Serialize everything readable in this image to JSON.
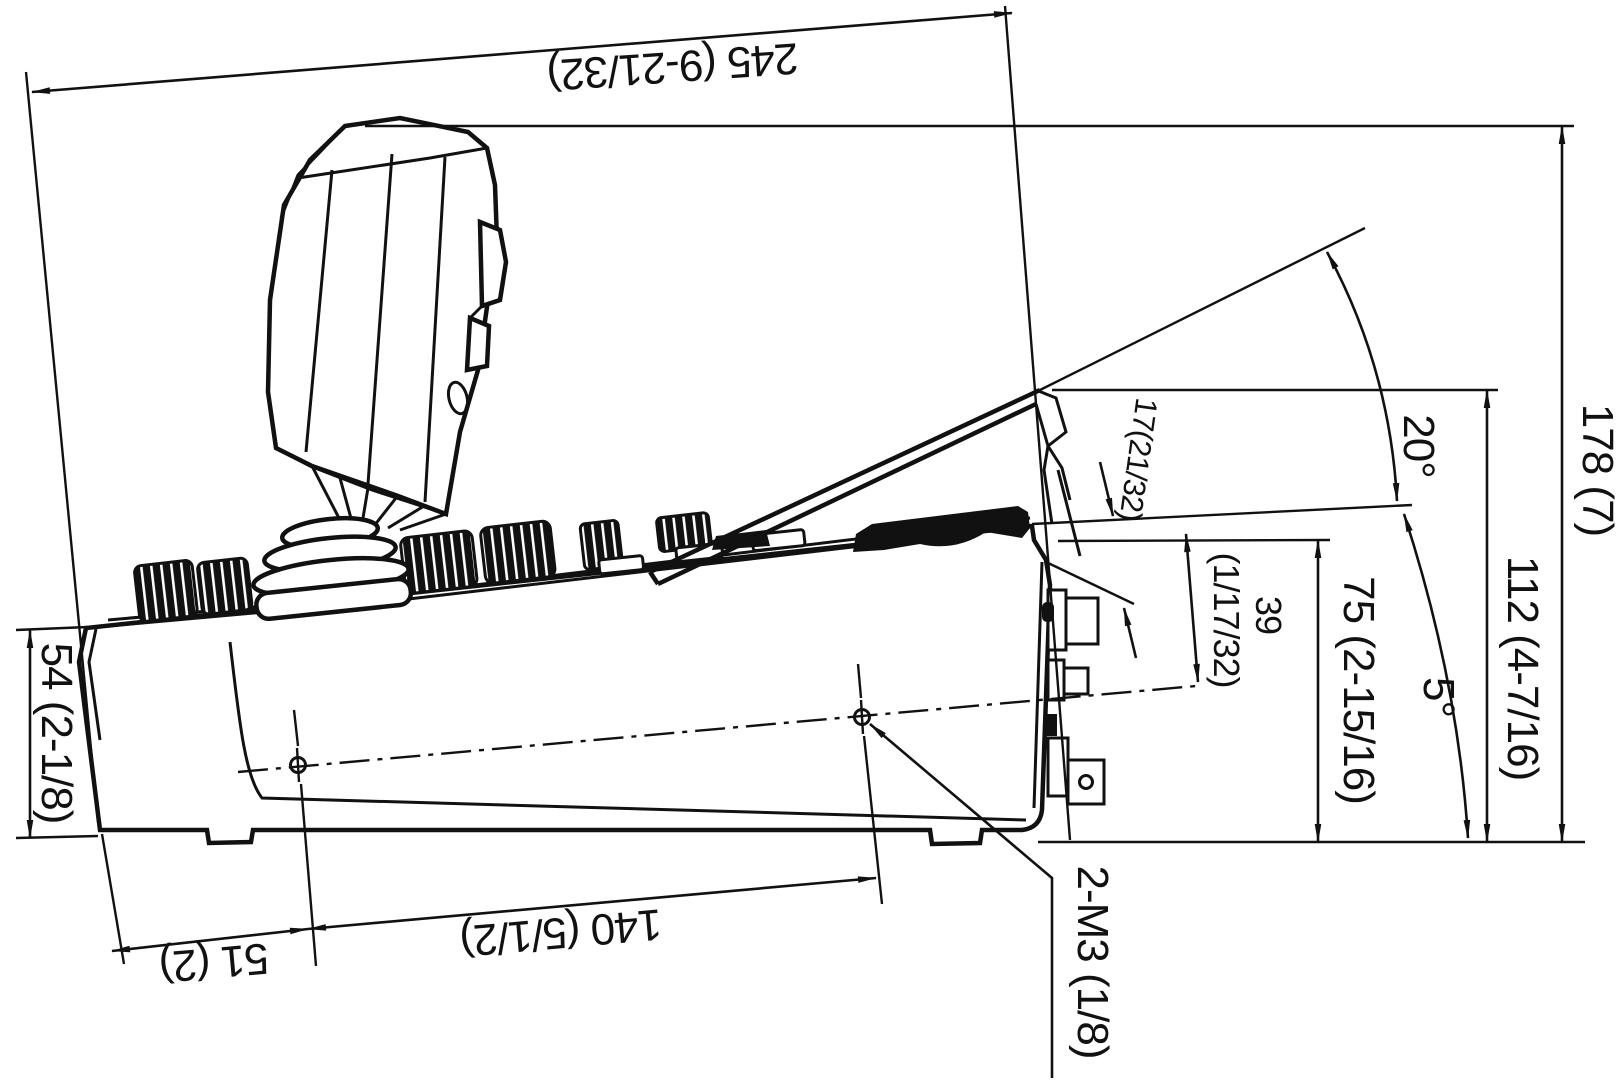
{
  "drawing": {
    "kind": "technical side-elevation drawing",
    "subject": "joystick remote control panel",
    "units_note": "mm (inches)",
    "line_color": "#111111",
    "background_color": "#ffffff",
    "dims": {
      "overall_depth": "245 (9-21/32)",
      "overall_height": "178 (7)",
      "display_top_height": "112 (4-7/16)",
      "rear_top_height": "75 (2-15/16)",
      "front_height": "54 (2-1/8)",
      "panel_step": "17(21/32)",
      "hole_drop_mm": "39",
      "hole_drop_in": "(1/17/32)",
      "hole_front_offset": "51 (2)",
      "hole_spacing": "140 (5/1/2)",
      "display_angle": "20°",
      "panel_angle": "5°",
      "screw_callout": "2-M3 (1/8)"
    }
  }
}
